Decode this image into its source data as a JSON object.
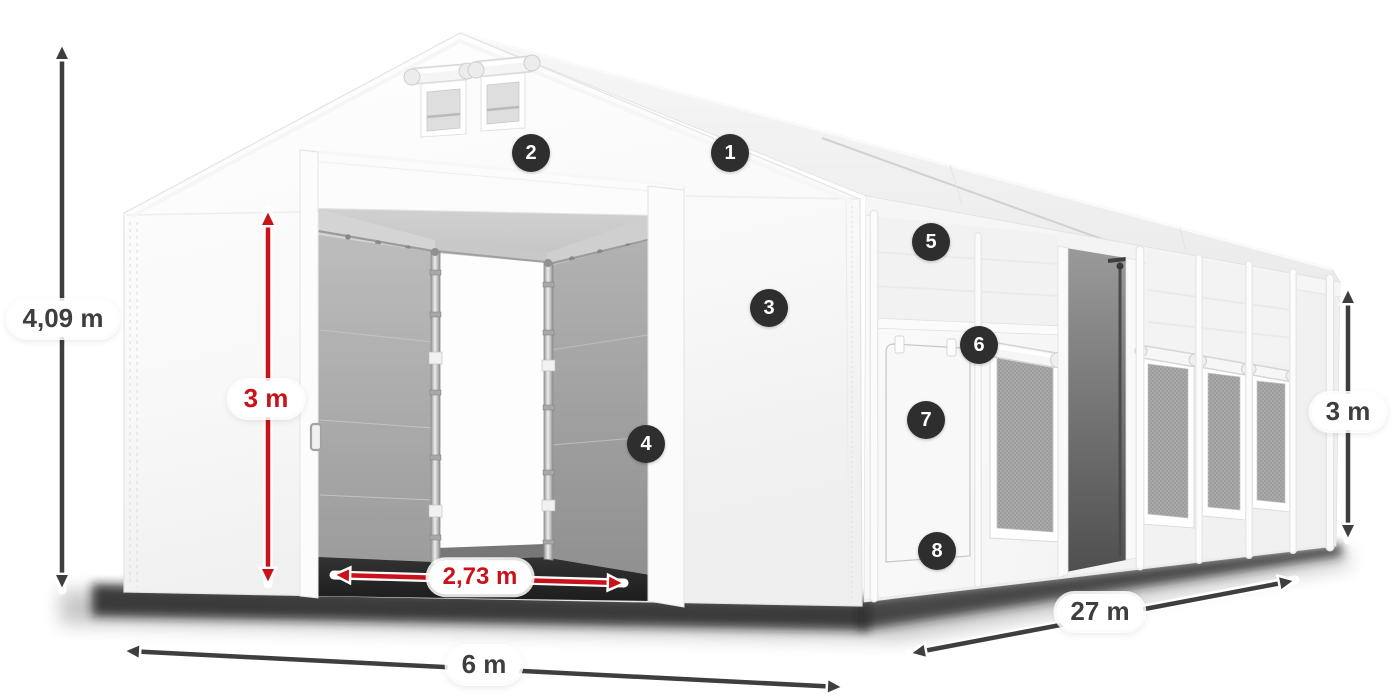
{
  "page": {
    "background": "#ffffff",
    "description": "Storage tent 6 x 27 m dimension diagram with numbered feature callouts"
  },
  "colors": {
    "dimension_dark": "#3e3e3e",
    "dimension_red": "#c9121a",
    "badge_background": "#2e2e2e",
    "badge_text": "#ffffff",
    "tent_white": "#ffffff",
    "interior_gray": "#a8a8a8"
  },
  "dimensions": [
    {
      "id": "total-height",
      "label": "4,09 m",
      "style": "dark",
      "orientation": "vertical"
    },
    {
      "id": "door-height",
      "label": "3 m",
      "style": "red",
      "orientation": "vertical"
    },
    {
      "id": "door-width",
      "label": "2,73 m",
      "style": "red",
      "orientation": "horizontal"
    },
    {
      "id": "width",
      "label": "6 m",
      "style": "dark",
      "orientation": "horizontal"
    },
    {
      "id": "length",
      "label": "27 m",
      "style": "dark",
      "orientation": "diagonal"
    },
    {
      "id": "side-height",
      "label": "3 m",
      "style": "dark",
      "orientation": "vertical"
    }
  ],
  "callouts": [
    {
      "number": "1"
    },
    {
      "number": "2"
    },
    {
      "number": "3"
    },
    {
      "number": "4"
    },
    {
      "number": "5"
    },
    {
      "number": "6"
    },
    {
      "number": "7"
    },
    {
      "number": "8"
    }
  ]
}
